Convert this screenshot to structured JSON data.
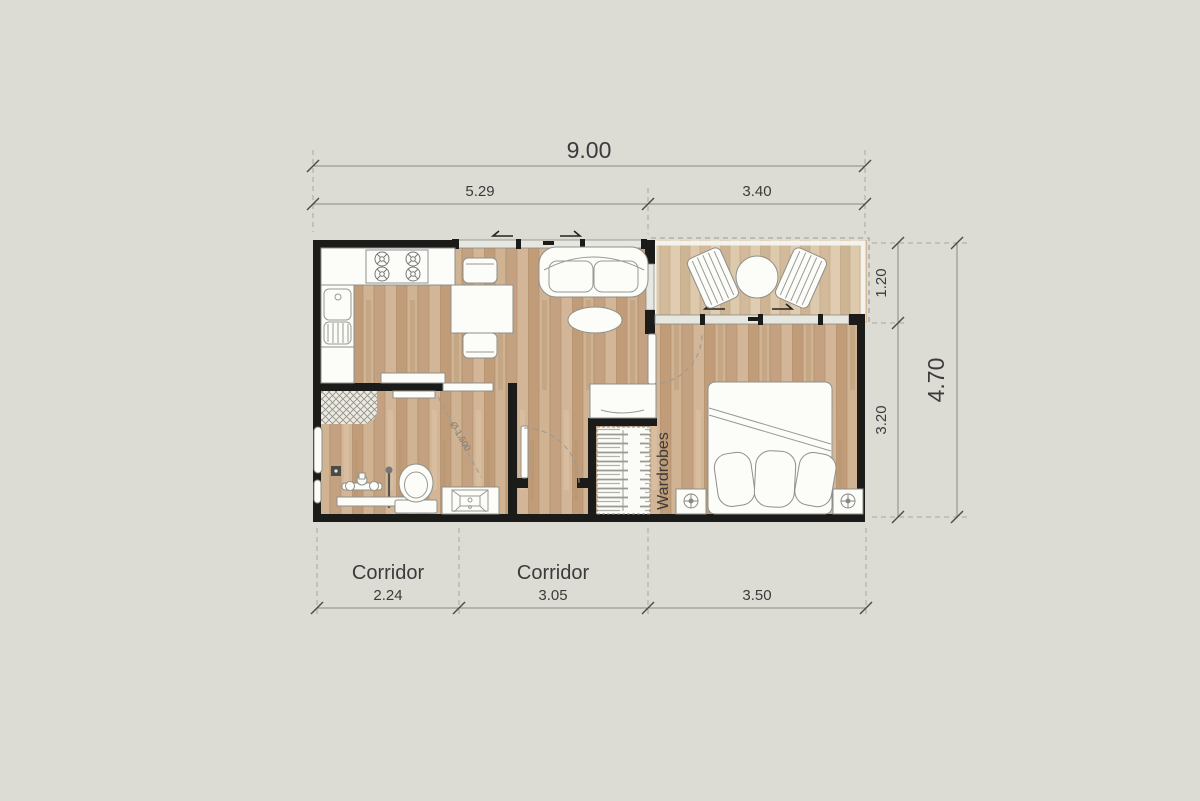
{
  "colors": {
    "background": "#dcdcd5",
    "wall": "#1b1b1a",
    "floor_wood": "#c8aa89",
    "balcony_wood": "#d6c0a2",
    "dimension_text": "#3b3b3b"
  },
  "dimensions": {
    "top_total": "9.00",
    "top_segment_left": "5.29",
    "top_segment_right": "3.40",
    "right_segment_top": "1.20",
    "right_segment_bottom": "3.20",
    "right_total": "4.70",
    "bottom_segment_left": "2.24",
    "bottom_segment_middle": "3.05",
    "bottom_segment_right": "3.50"
  },
  "labels": {
    "corridor_left": "Corridor",
    "corridor_middle": "Corridor",
    "wardrobes": "Wardrobes",
    "turning_circle": "Ø 1.500"
  }
}
